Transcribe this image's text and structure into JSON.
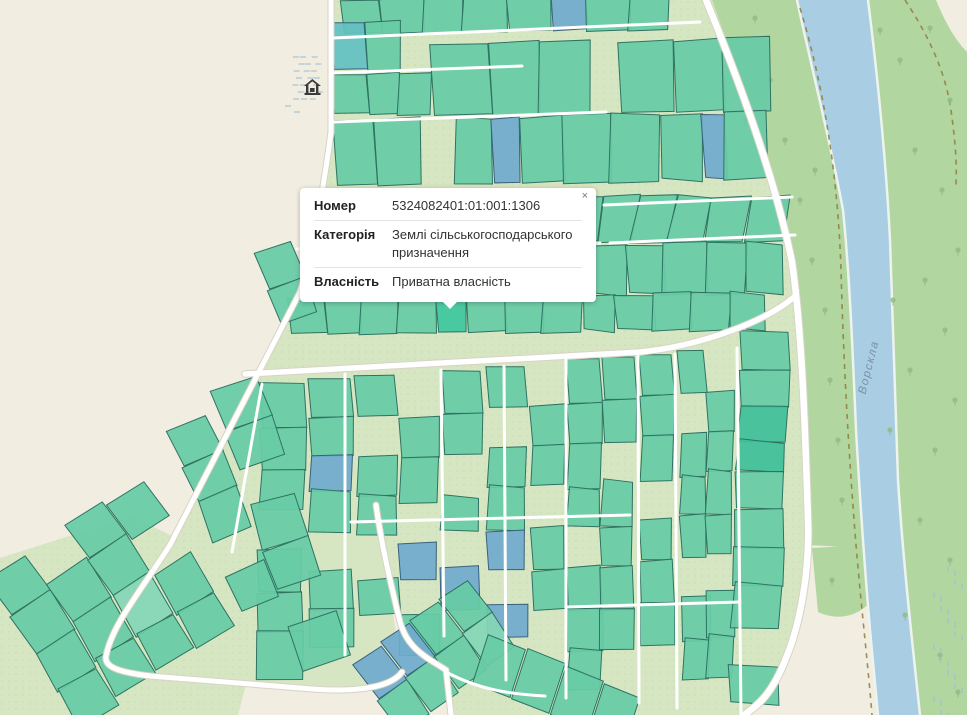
{
  "popup": {
    "close_label": "×",
    "rows": [
      {
        "label": "Номер",
        "value": "5324082401:01:001:1306"
      },
      {
        "label": "Категорія",
        "value": "Землі сільськогосподарського призначення"
      },
      {
        "label": "Власність",
        "value": "Приватна власність"
      }
    ]
  },
  "map": {
    "river_label": "Ворскла",
    "icons": {
      "water_well": "water-well-icon",
      "marsh": "marsh-icon",
      "tree": "tree-icon",
      "close": "close-icon"
    }
  },
  "colors": {
    "background": "#f1ede1",
    "farmland": "#d7e6c2",
    "farmland_dots": "#bcd6a2",
    "forest": "#b1d69f",
    "water": "#a9cde2",
    "road": "#ffffff",
    "road_casing": "#d8d3c6",
    "track_dashed": "#8e7d3f",
    "parcel_teal": "#67cba6",
    "parcel_teal_dark": "#40c09a",
    "parcel_teal_light": "#84d6b6",
    "parcel_blue": "#70aace",
    "parcel_cyan": "#63bfc2",
    "parcel_selected": "#3ec69c",
    "parcel_border": "#2f7262",
    "parcel_border_blue": "#3a617d",
    "river_label_color": "#7b90a8",
    "marsh": "#a4bfd0",
    "tree": "#93bb85",
    "well_icon": "#3b3b3b"
  }
}
